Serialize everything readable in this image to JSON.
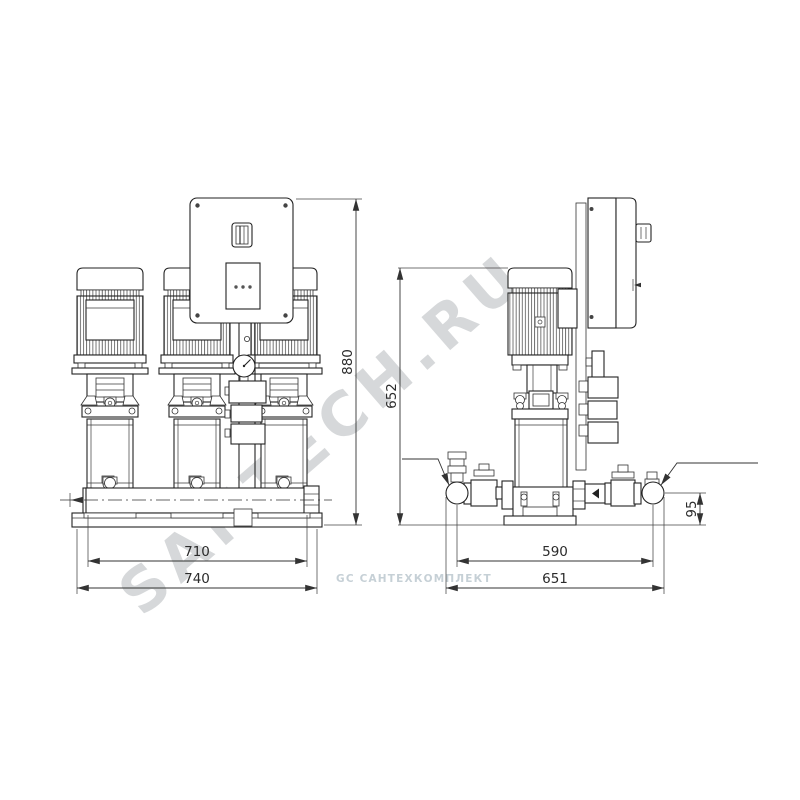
{
  "drawing": {
    "front_view": {
      "label": "front view",
      "dim_height": "880",
      "dim_manifold": "710",
      "dim_base": "740"
    },
    "side_view": {
      "label": "side view",
      "dim_height": "652",
      "dim_ports": "590",
      "dim_overall": "651",
      "dim_port_axis": "95"
    },
    "watermark_main": "SANTECH.RU",
    "watermark_small": "GC САНТЕХКОМПЛЕКТ"
  }
}
